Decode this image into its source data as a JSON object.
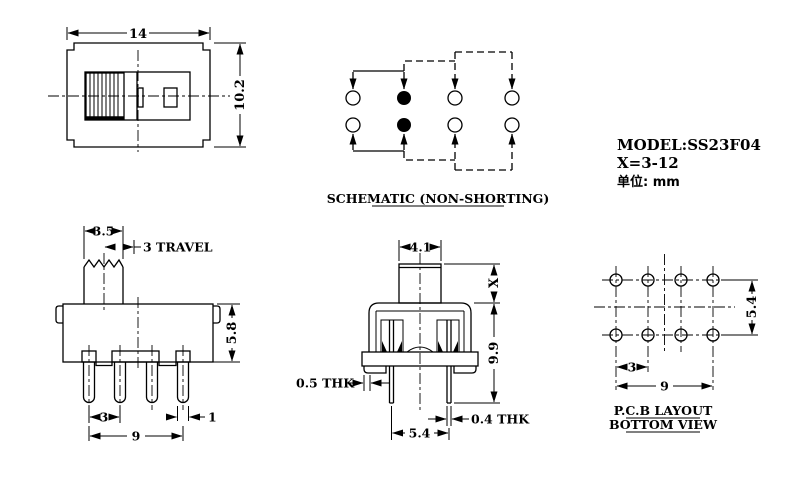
{
  "page": {
    "background": "#ffffff",
    "line_color": "#000000"
  },
  "title_block": {
    "model": "MODEL:SS23F04",
    "x_range": "X=3-12",
    "unit_label": "单位: mm"
  },
  "top_view": {
    "dim_width": "14",
    "dim_height": "10.2"
  },
  "schematic": {
    "label": "SCHEMATIC (NON-SHORTING)",
    "poles": 2,
    "throws_per_pole": 4,
    "filled_contact_column": 2
  },
  "side_view": {
    "dim_stem": "3.5",
    "dim_travel": "3 TRAVEL",
    "dim_height": "5.8",
    "dim_pitch": "3",
    "dim_pin_width": "1",
    "dim_span": "9"
  },
  "front_view": {
    "dim_stem": "4.1",
    "dim_x": "X",
    "dim_height": "9.9",
    "dim_wall": "0.5 THK",
    "dim_leg": "0.4 THK",
    "dim_span": "5.4"
  },
  "pcb_view": {
    "dim_rows": "5.4",
    "dim_pitch": "3",
    "dim_span": "9",
    "label_line1": "P.C.B LAYOUT",
    "label_line2": "BOTTOM VIEW"
  }
}
